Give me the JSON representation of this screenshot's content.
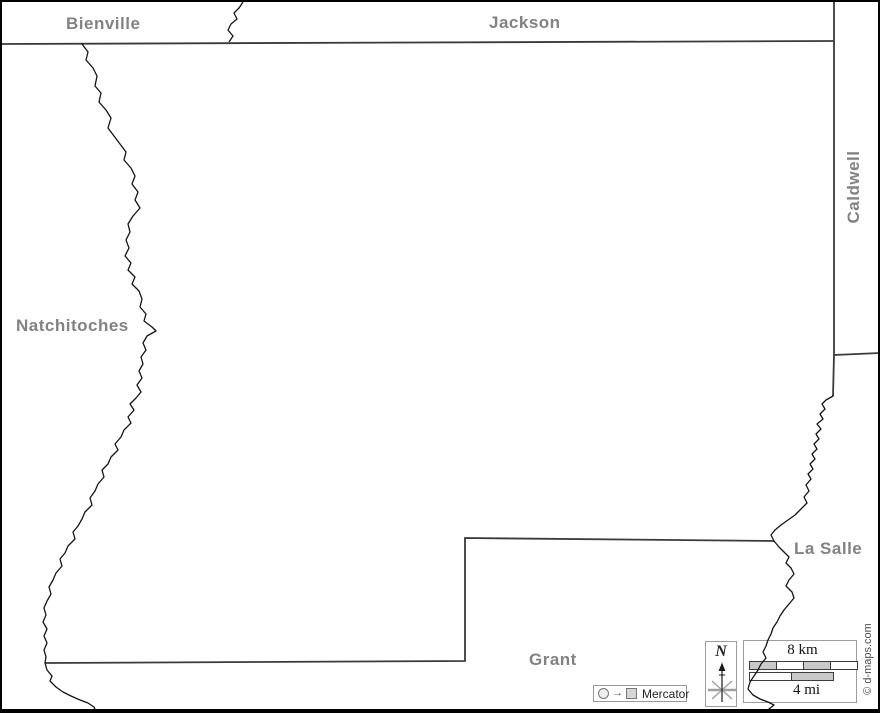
{
  "labels": {
    "bienville": "Bienville",
    "jackson": "Jackson",
    "caldwell": "Caldwell",
    "natchitoches": "Natchitoches",
    "la_salle": "La Salle",
    "grant": "Grant"
  },
  "compass": {
    "north": "N"
  },
  "scalebar": {
    "km": "8 km",
    "mi": "4 mi"
  },
  "projection": {
    "name": "Mercator",
    "arrow": "→"
  },
  "credit": {
    "text": "© d-maps.com"
  },
  "colors": {
    "label_gray": "#828282",
    "river_line": "#141414",
    "admin_line": "#3a3a3a",
    "bar_fill": "#c9c9c9",
    "box_border": "#9c9c9c",
    "frame": "#000000"
  }
}
